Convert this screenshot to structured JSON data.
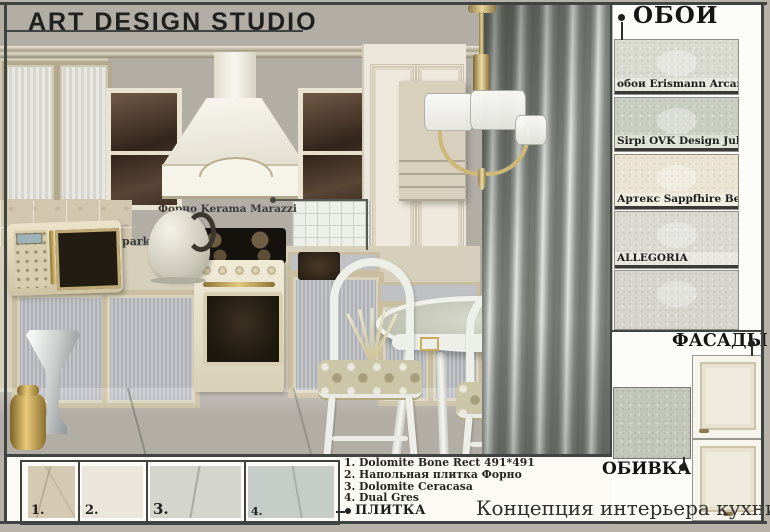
{
  "board": {
    "title": "ART DESIGN STUDIO",
    "caption": "Концепция интерьера кухни",
    "frame_color": "#3f4440"
  },
  "kitchen": {
    "backsplash_label": "Форно Kerama Marazzi",
    "floor_label": "park"
  },
  "wallpaper": {
    "title": "ОБОИ",
    "swatches": [
      {
        "label": "обои Erismann Arcano",
        "color": "#d9dbd1"
      },
      {
        "label": "Sirpi OVK Design Juliet uni",
        "color": "#c9cfc2"
      },
      {
        "label": "Артекс Sappfhire Венеция",
        "color": "#ebe4d3"
      },
      {
        "label": "ALLEGORIA",
        "color": "#dadad2"
      },
      {
        "label": "",
        "color": "#d6d6ce"
      }
    ]
  },
  "facades": {
    "title": "ФАСАДЫ",
    "door_color": "#efebdf"
  },
  "upholstery": {
    "title": "ОБИВКА",
    "fabric_color": "#c3c7b9"
  },
  "tiles": {
    "title": "ПЛИТКА",
    "list": [
      "1.  Dolomite Bone Rect 491*491",
      "2. Напольная плитка Форно",
      "3. Dolomite Ceracasa",
      "4. Dual Gres"
    ],
    "samples": [
      {
        "num": "1.",
        "color": "#d6c9b3"
      },
      {
        "num": "2.",
        "color": "#eae6db"
      },
      {
        "num": "3.",
        "color": "#d4d6ce"
      },
      {
        "num": "4.",
        "color": "#c6ccc8"
      }
    ]
  }
}
